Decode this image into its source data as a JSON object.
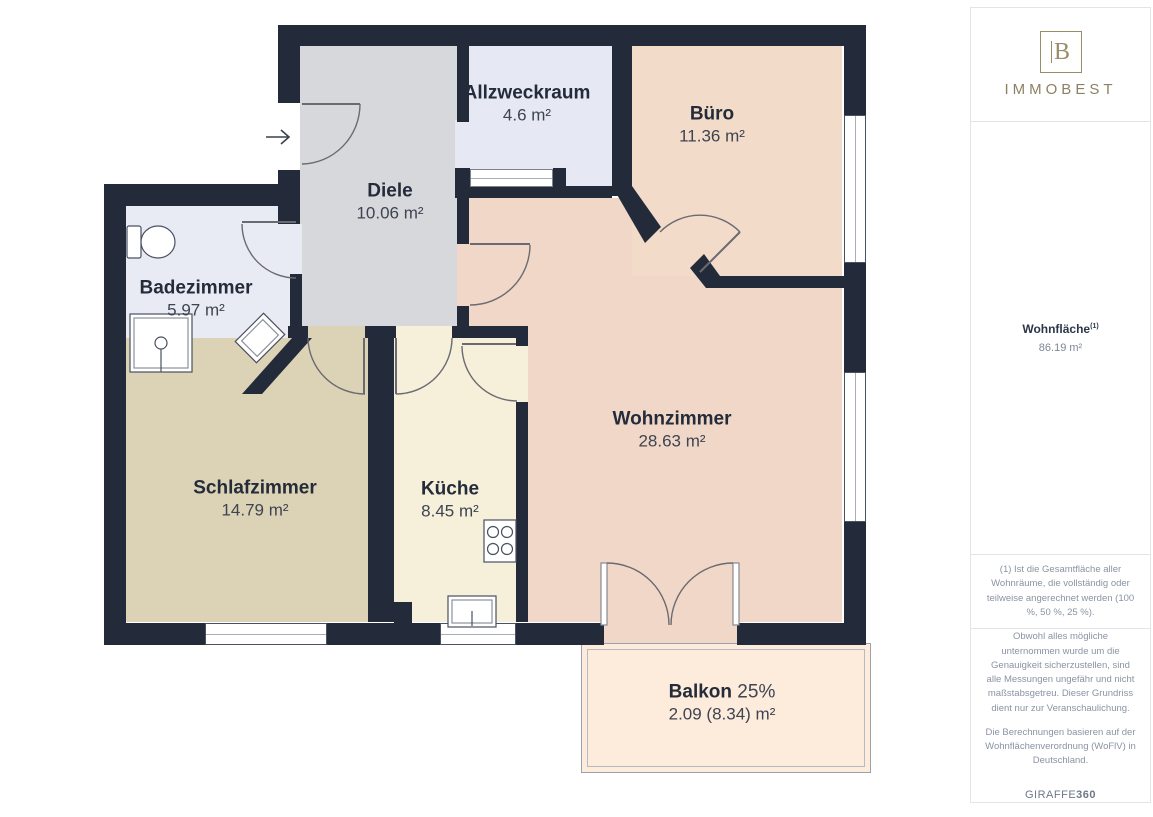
{
  "plan": {
    "rooms": [
      {
        "id": "allzweckraum",
        "name": "Allzweckraum",
        "area": "4.6 m²"
      },
      {
        "id": "buero",
        "name": "Büro",
        "area": "11.36 m²"
      },
      {
        "id": "diele",
        "name": "Diele",
        "area": "10.06 m²"
      },
      {
        "id": "badezimmer",
        "name": "Badezimmer",
        "area": "5.97 m²"
      },
      {
        "id": "wohnzimmer",
        "name": "Wohnzimmer",
        "area": "28.63 m²"
      },
      {
        "id": "schlafzimmer",
        "name": "Schlafzimmer",
        "area": "14.79 m²"
      },
      {
        "id": "kueche",
        "name": "Küche",
        "area": "8.45 m²"
      },
      {
        "id": "balkon",
        "name": "Balkon",
        "percent": "25%",
        "area": "2.09 (8.34) m²"
      }
    ],
    "colors": {
      "wall": "#232b3a",
      "diele": "#d7d8dc",
      "allzweckraum": "#e6e9f3",
      "badezimmer": "#e9ebf4",
      "buero": "#f3dbc9",
      "wohnzimmer": "#f1d7c7",
      "schlafzimmer": "#dcd2b5",
      "kueche": "#f6efd9",
      "balkon": "#fdecdc"
    }
  },
  "sidebar": {
    "logo": {
      "monogram": "B",
      "text": "IMMOBEST"
    },
    "summary": {
      "label": "Wohnfläche",
      "sup": "(1)",
      "value": "86.19 m²"
    },
    "footnote": "(1) Ist die Gesamtfläche aller Wohnräume, die vollständig oder teilweise angerechnet werden (100 %, 50 %, 25 %).",
    "disclaimer1": "Obwohl alles mögliche unternommen wurde um die Genauigkeit sicherzustellen, sind alle Messungen ungefähr und nicht maßstabsgetreu. Dieser Grundriss dient nur zur Veranschaulichung.",
    "disclaimer2": "Die Berechnungen basieren auf der Wohnflächenverordnung (WoFlV) in Deutschland.",
    "brand": {
      "name": "GIRAFFE",
      "suffix": "360"
    }
  }
}
